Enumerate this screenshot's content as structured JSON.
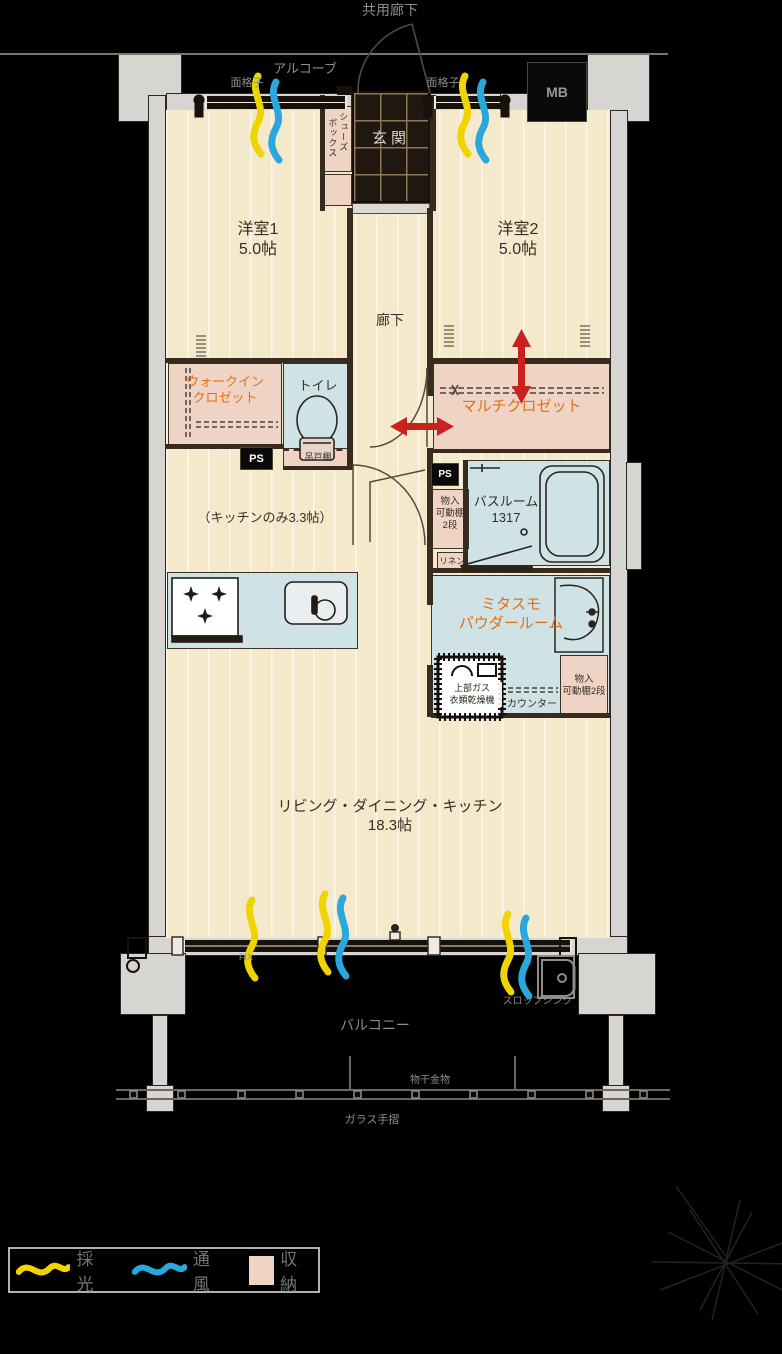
{
  "outside": {
    "common_corridor": "共用廊下",
    "alcove": "アルコーブ",
    "grill": "面格子",
    "mb": "MB",
    "fix": "FIX",
    "balcony": "バルコニー",
    "laundry_hardware": "物干金物",
    "glass_rail": "ガラス手摺",
    "slop_sink": "スロップシンク"
  },
  "rooms": {
    "entrance": "玄関",
    "shoes_col1": "シューズ",
    "shoes_col2": "ボックス",
    "western1": [
      "洋室1",
      "5.0帖"
    ],
    "western2": [
      "洋室2",
      "5.0帖"
    ],
    "hallway": "廊下",
    "wic": [
      "ウォークイン",
      "クロゼット"
    ],
    "toilet": "トイレ",
    "hanging_cupboard": "吊戸棚",
    "ps": "PS",
    "multi_closet": "マルチクロゼット",
    "bathroom": [
      "バスルーム",
      "1317"
    ],
    "storage_left": [
      "物入",
      "可動棚",
      "2段"
    ],
    "linen": "リネン",
    "kitchen_note": "（キッチンのみ3.3帖）",
    "powder_room": [
      "ミタスモ",
      "パウダールーム"
    ],
    "gas_dryer": [
      "上部ガス",
      "衣類乾燥機"
    ],
    "counter": "カウンター",
    "storage_right": [
      "物入",
      "可動棚2段"
    ],
    "ldk": [
      "リビング・ダイニング・キッチン",
      "18.3帖"
    ]
  },
  "legend": {
    "daylight": "採光",
    "ventilation": "通風",
    "storage": "収納"
  },
  "colors": {
    "floor": "#f5e9cc",
    "storage_pink": "#efd4c6",
    "wet_blue": "#cfe3e7",
    "accent_orange": "#e07018",
    "arrow_red": "#c9211e",
    "daylight_yellow": "#f0d400",
    "ventilation_blue": "#2aa7dc"
  }
}
